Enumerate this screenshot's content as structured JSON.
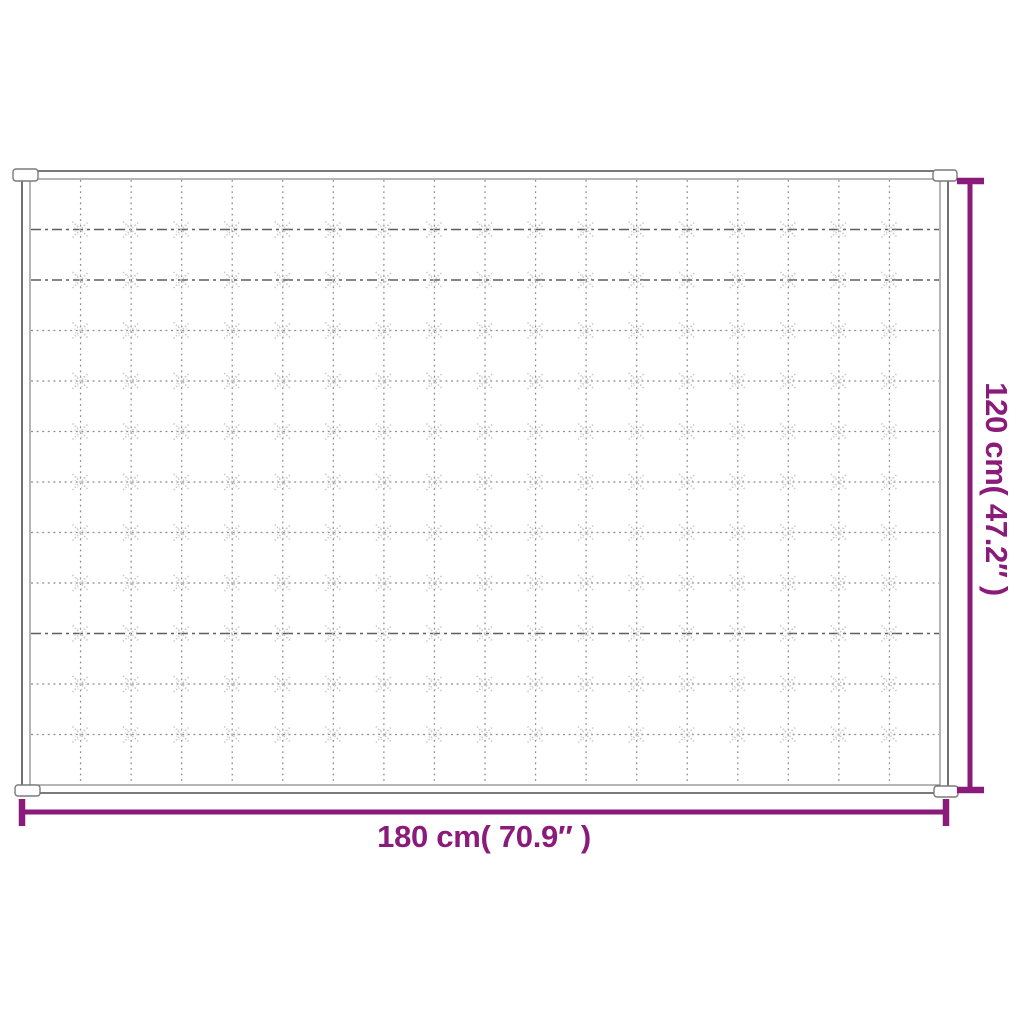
{
  "diagram": {
    "width_label": "180 cm( 70.9″ )",
    "height_label": "120 cm( 47.2″ )",
    "accent_color": "#8B1B7A",
    "background_color": "#FFFFFF",
    "blanket": {
      "outline_color": "#4E4E4E",
      "inner_outline_color": "#7A7A7A",
      "grid_line_color": "#8E8E8E",
      "dark_row_color": "#5E5E5E",
      "tuft_color": "#C6C6C6",
      "vertical_grid_lines": 17,
      "horizontal_grid_lines": 11,
      "dark_row_indexes": [
        0,
        1,
        8
      ]
    }
  }
}
